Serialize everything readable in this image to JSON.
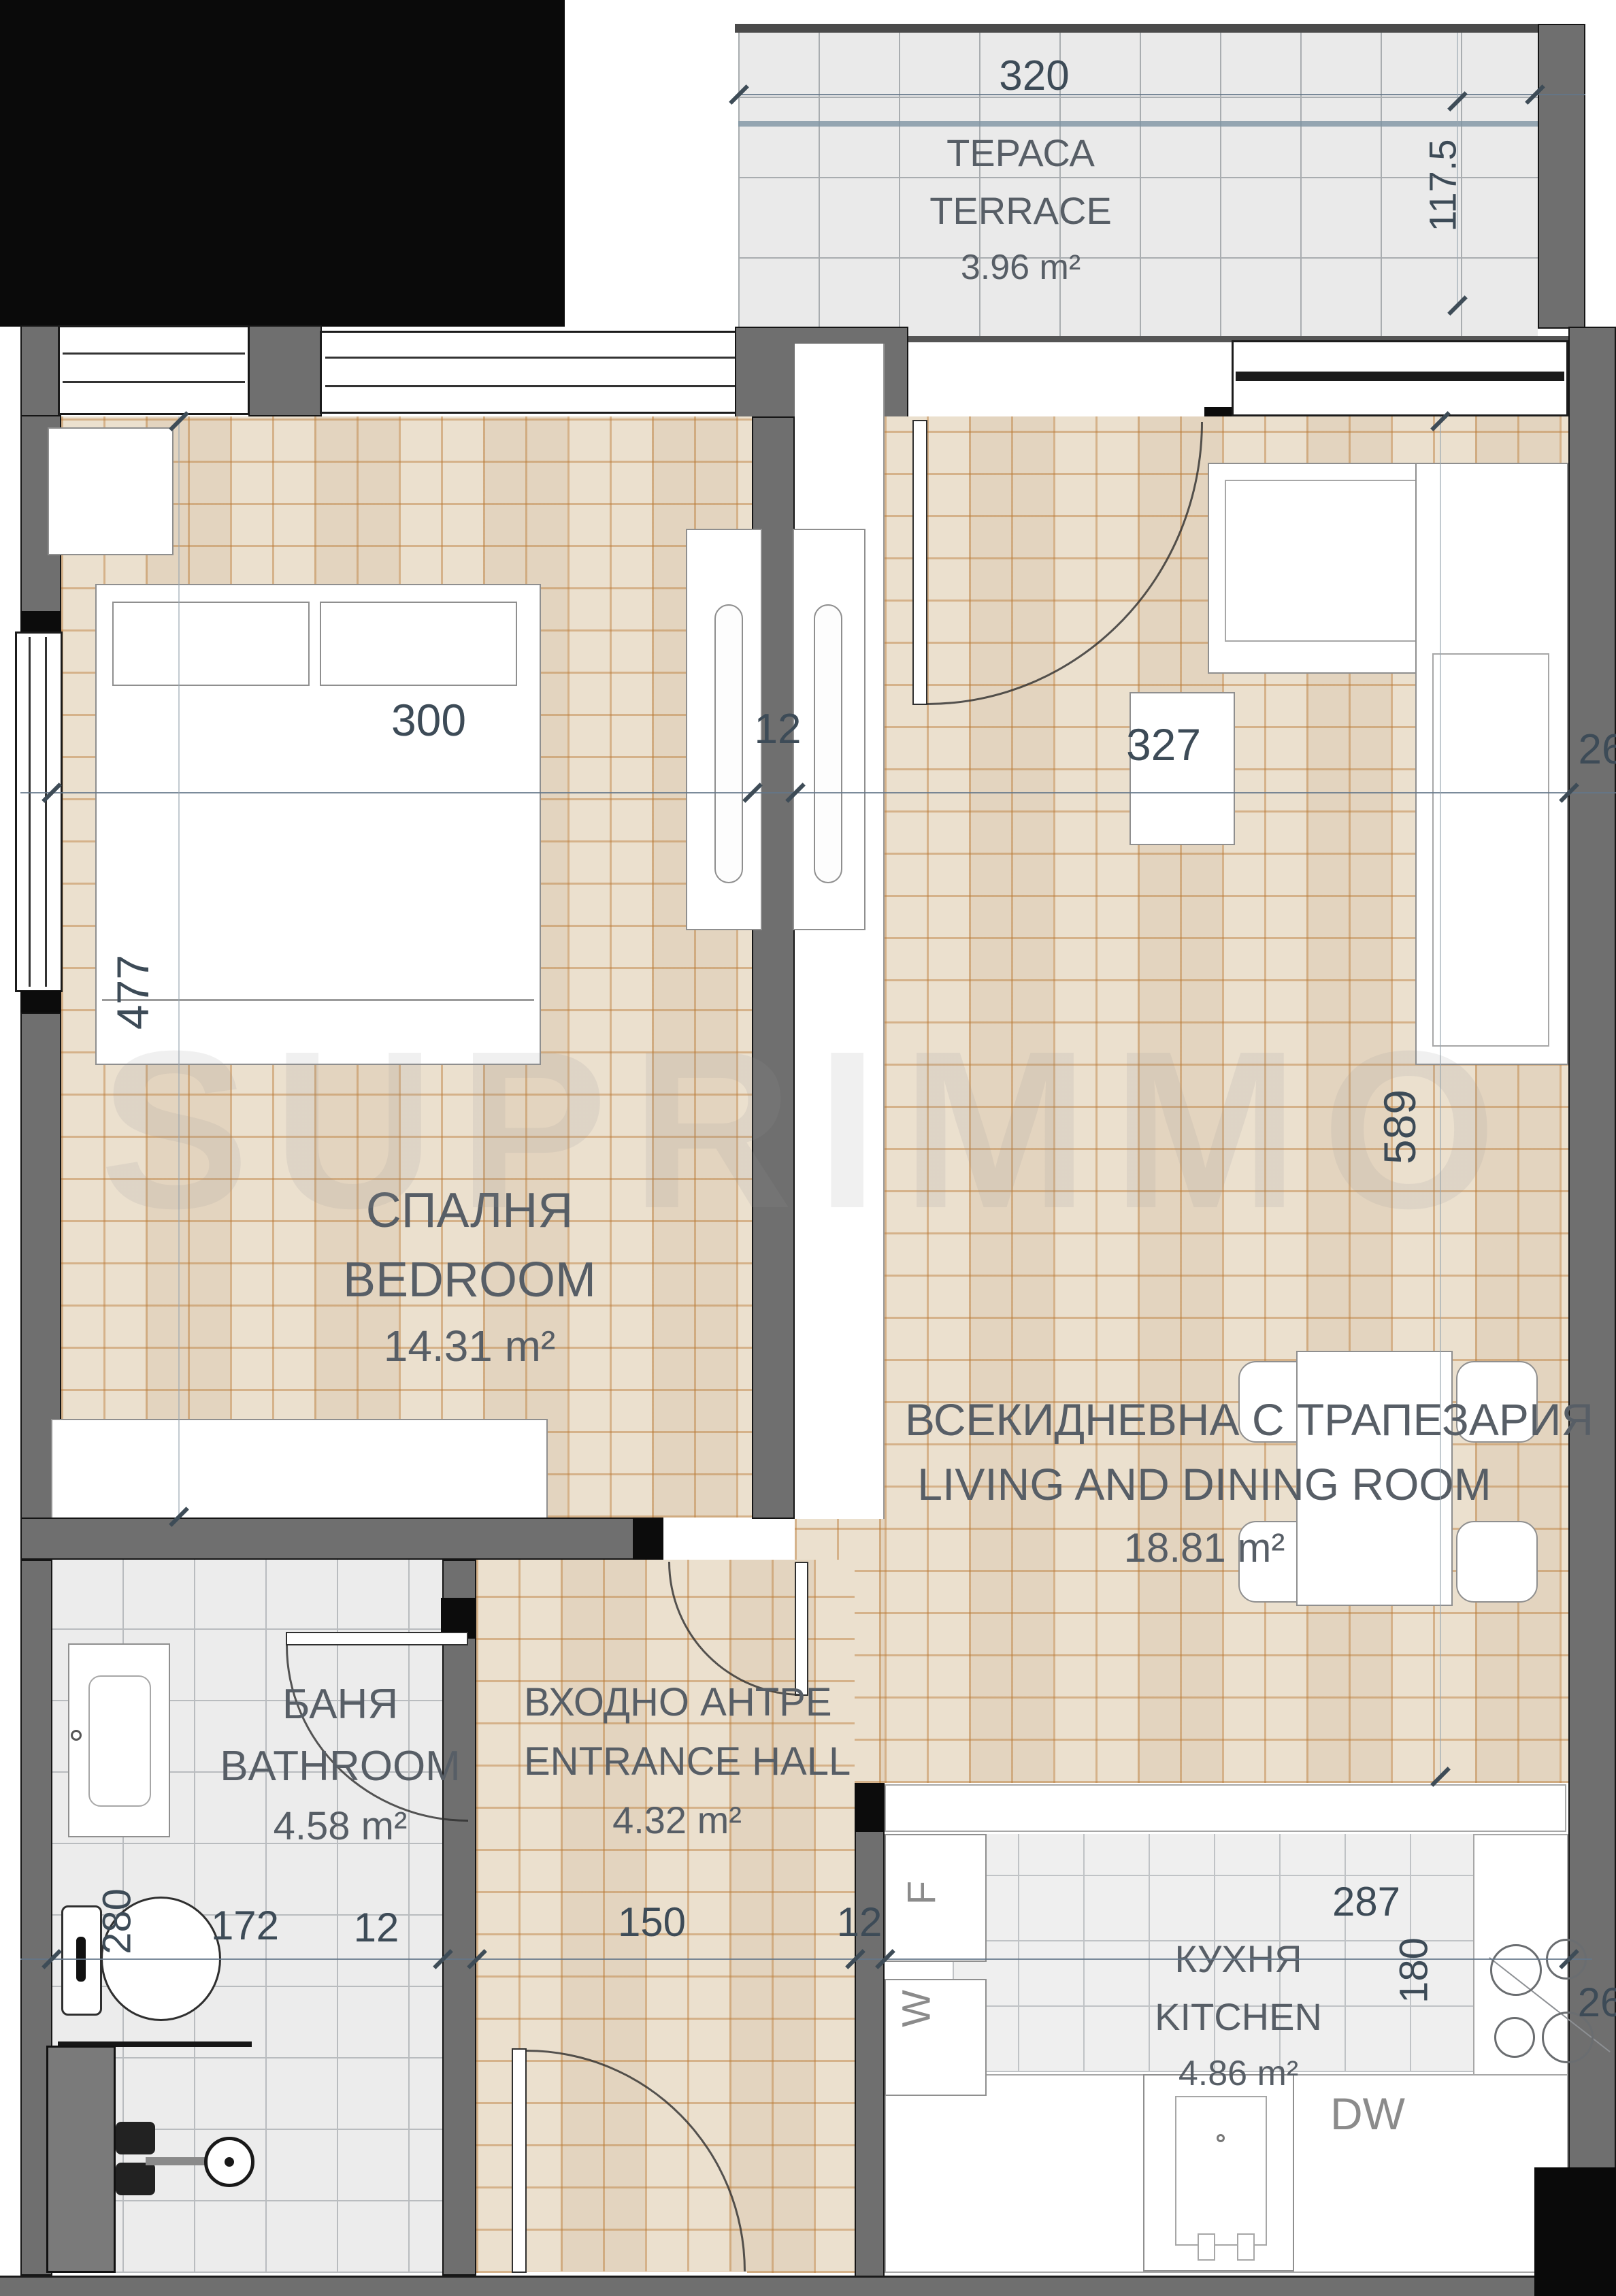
{
  "watermark": {
    "text": "SUPRIMMO"
  },
  "rooms": {
    "terrace": {
      "bg": "ТЕРАСА",
      "en": "TERRACE",
      "area": "3.96 m²"
    },
    "bedroom": {
      "bg": "СПАЛНЯ",
      "en": "BEDROOM",
      "area": "14.31 m²"
    },
    "living": {
      "bg": "ВСЕКИДНЕВНА С ТРАПЕЗАРИЯ",
      "en": "LIVING AND DINING ROOM",
      "area": "18.81 m²"
    },
    "bathroom": {
      "bg": "БАНЯ",
      "en": "BATHROOM",
      "area": "4.58 m²"
    },
    "hall": {
      "bg": "ВХОДНО АНТРЕ",
      "en": "ENTRANCE HALL",
      "area": "4.32 m²"
    },
    "kitchen": {
      "bg": "КУХНЯ",
      "en": "KITCHEN",
      "area": "4.86 m²"
    }
  },
  "dims": {
    "terrace_w": "320",
    "terrace_d": "117.5",
    "bedroom_w": "300",
    "wall_mid": "12",
    "living_w": "327",
    "wall_right_top": "26",
    "bedroom_d": "477",
    "living_d": "589",
    "bath_w": "172",
    "bath_wall": "12",
    "hall_w": "150",
    "hall_wall": "12",
    "kitchen_w": "287",
    "wall_right_bottom": "26",
    "bath_d": "280",
    "kitchen_d": "180"
  },
  "appliances": {
    "fridge": "F",
    "washer": "W",
    "dishwasher": "DW"
  },
  "colors": {
    "wall": "#6f6f6f",
    "parquet": "#e9dcc9",
    "parquet_line": "#ba7a36",
    "tile": "#ececec",
    "dim_text": "#3d4b57",
    "room_text": "#575e66"
  }
}
